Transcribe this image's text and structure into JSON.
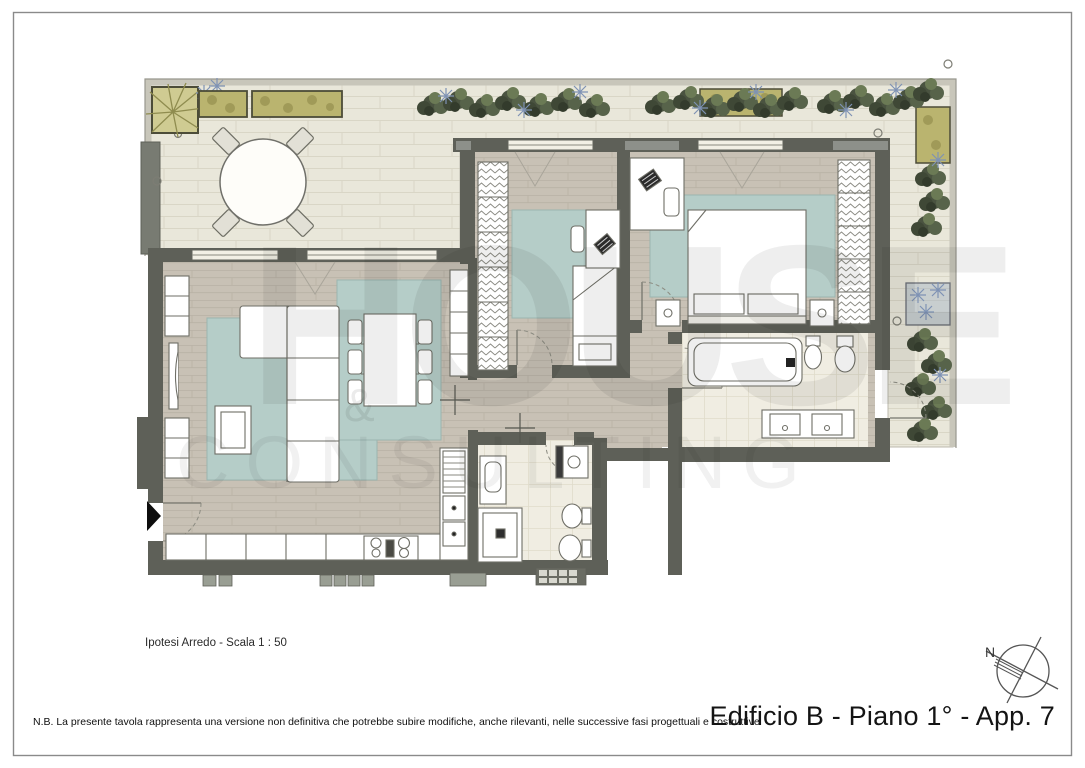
{
  "texts": {
    "scale_note": "Ipotesi Arredo - Scala  1 : 50",
    "disclaimer": "N.B. La presente tavola rappresenta una versione non definitiva che potrebbe subire modifiche, anche rilevanti, nelle successive fasi progettuali e costruttive",
    "title": "Edificio B - Piano 1° - App. 7"
  },
  "compass": {
    "north_label": "N"
  },
  "watermark": {
    "word": "HOUSE",
    "ampersand": "&",
    "subword": "CONSULTING"
  },
  "colors": {
    "wall": "#5e6058",
    "wall_panel": "#8d908a",
    "wood_floor": "#c8c1b5",
    "terrace_tile": "#e9e7da",
    "bath_tile": "#f0ede2",
    "rug": "#b5cdc8",
    "furniture_fill": "#ffffff",
    "furniture_stroke": "#6e6e66",
    "planter_khaki": "#bab46f",
    "planter_dark": "#4a5340",
    "planter_blue": "#7e92b4",
    "parapet": "#c8c6ba",
    "entrance_marker": "#0d0d0d",
    "frame": "#8a8a8a"
  }
}
